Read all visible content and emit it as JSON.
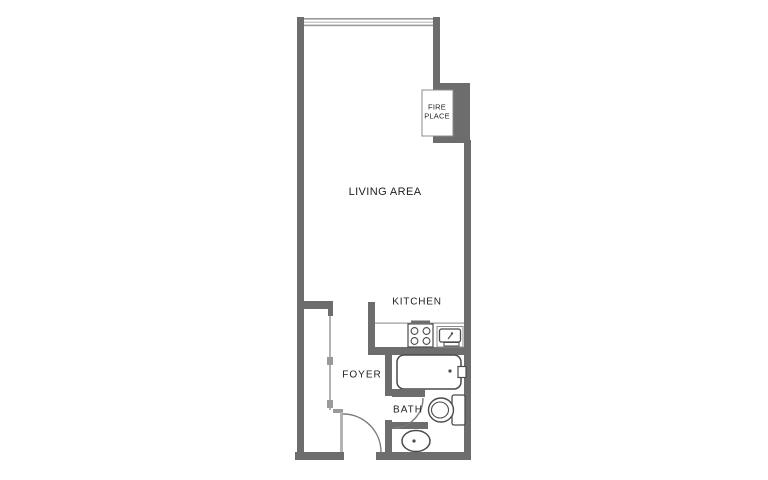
{
  "plan": {
    "type": "studio-apartment-floor-plan",
    "rooms": {
      "living_area": {
        "label": "LIVING AREA"
      },
      "kitchen": {
        "label": "KITCHEN"
      },
      "foyer": {
        "label": "FOYER"
      },
      "bath": {
        "label": "BATH"
      },
      "fireplace": {
        "label_line1": "FIRE",
        "label_line2": "PLACE"
      }
    },
    "fixtures": [
      "window-top",
      "fireplace",
      "closet-sliding-doors",
      "entry-door-swing",
      "stove-4-burners",
      "kitchen-sink",
      "bathtub",
      "bath-door-swing",
      "toilet",
      "bath-sink"
    ]
  },
  "colors": {
    "wall": "#6d6d6d",
    "light_line": "#b3b3b3",
    "med_line": "#9a9a9a",
    "fixture_line": "#4a4a4a",
    "door_arc": "#7a7a7a",
    "text": "#1f1f1f",
    "background": "#ffffff"
  }
}
